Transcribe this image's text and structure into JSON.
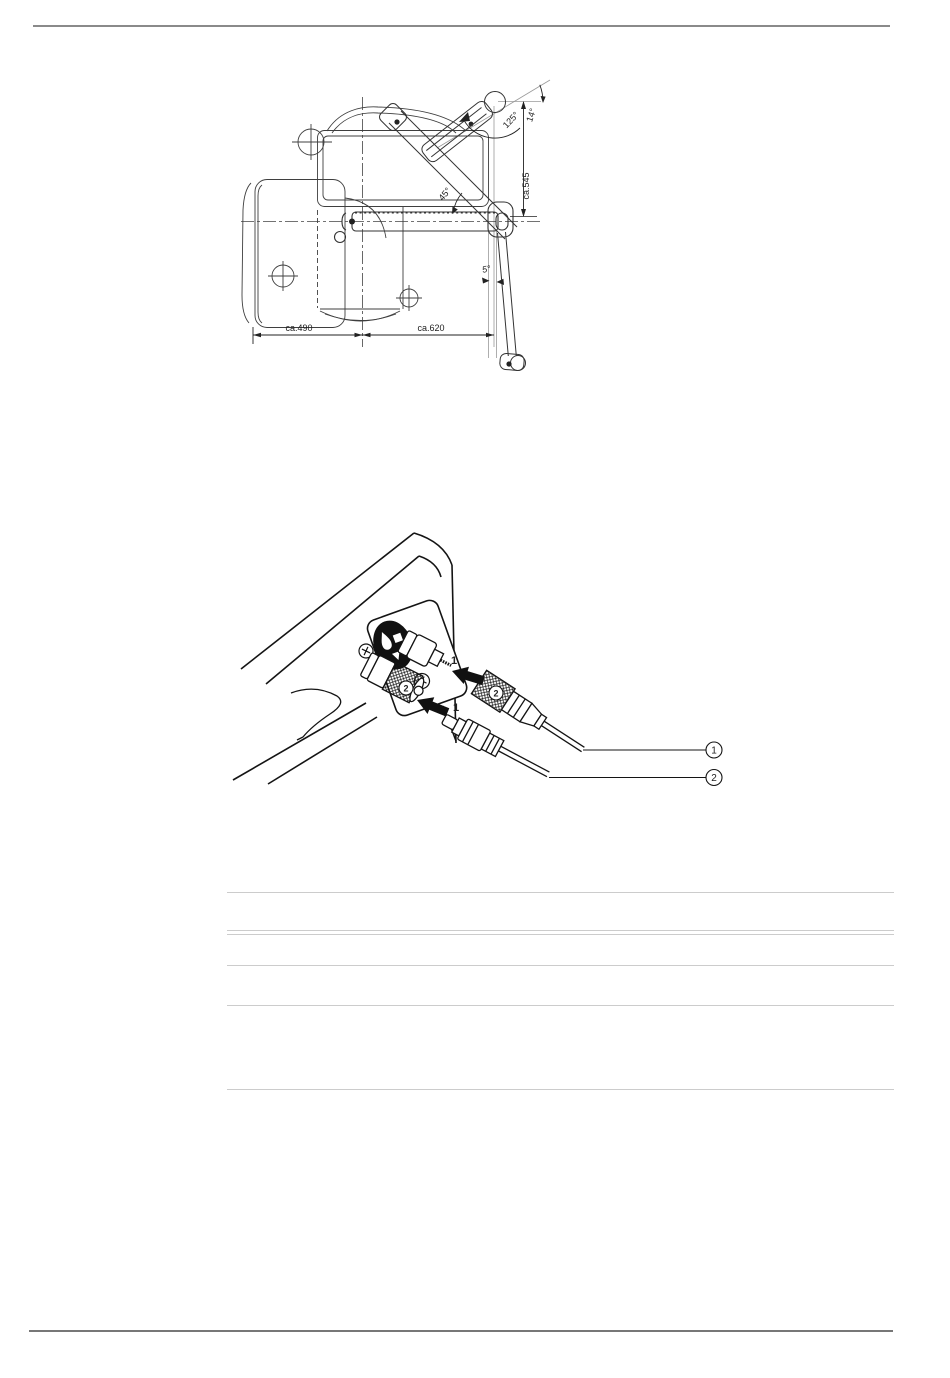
{
  "page": {
    "background": "#ffffff",
    "header_rule_color": "#8a8a8a",
    "footer_rule_color": "#777777",
    "table_rule_color": "#cccccc",
    "drawing_line_color": "#3f3f3f",
    "illustration_line_color": "#141414"
  },
  "figure1": {
    "description": "Top-view dimensional drawing of unit with swivel arm",
    "labels": {
      "angle_upper": "125°",
      "angle_head": "14°",
      "dim_vertical": "ca.545",
      "angle_arm": "45°",
      "angle_lower_arm": "5°",
      "dim_width_left": "ca.490",
      "dim_width_right": "ca.620"
    }
  },
  "figure2": {
    "description": "Rear panel cable connection drawing",
    "labels": {
      "jack_upper": "1",
      "jack_lower": "2",
      "connector_ring_upper": "2",
      "plug_lower": "1",
      "callout_cable_upper": "1",
      "callout_cable_lower": "2"
    }
  }
}
